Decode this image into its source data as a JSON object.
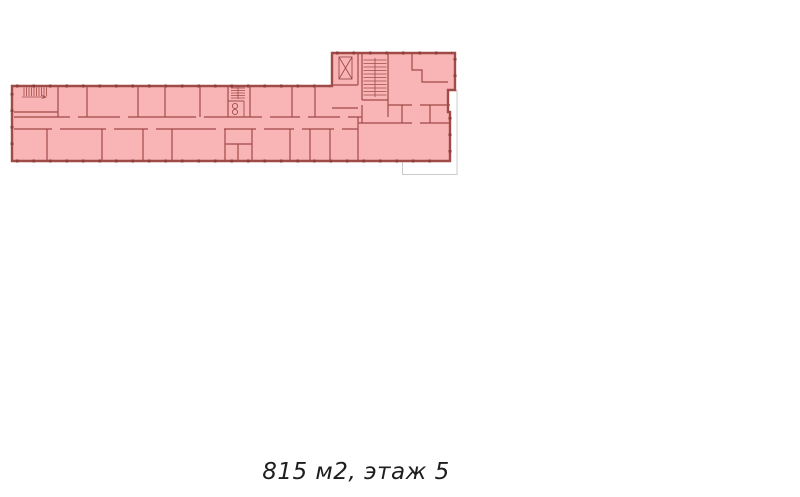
{
  "page": {
    "width": 800,
    "height": 497,
    "background": "#ffffff"
  },
  "caption": {
    "text": "815 м2, этаж 5",
    "area_m2": 815,
    "floor": 5
  },
  "plan": {
    "type": "floor-plan",
    "features": [
      "building-footprint",
      "corridor",
      "staircase-left",
      "wc-stair-block-center",
      "elevator-shaft-wing",
      "staircase-wing",
      "terrace-ghost-outline",
      "window-ticks"
    ]
  },
  "colors": {
    "pageBg": "#ffffff",
    "planFill": "#f9b5b5",
    "wall": "#a04b48",
    "window": "#8b3d3a",
    "ghost": "#cbcbcb",
    "caption": "#1e1e1e"
  }
}
